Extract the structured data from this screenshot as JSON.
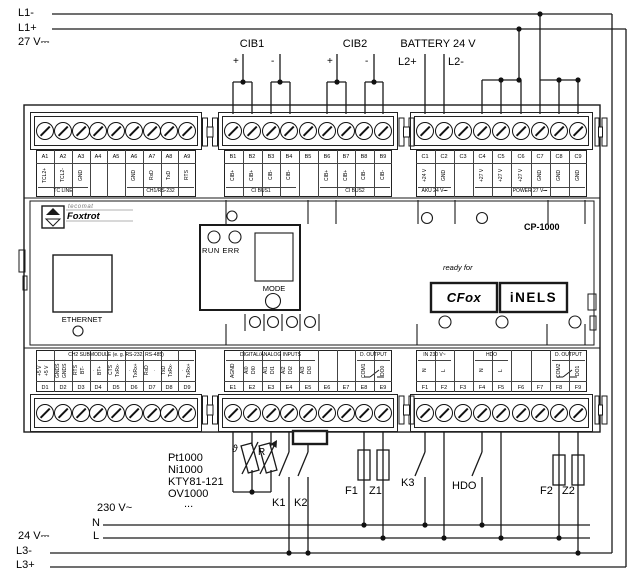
{
  "top": {
    "l1_minus": "L1-",
    "l1_plus": "L1+",
    "supply": "27 V⎓",
    "cib1": {
      "label": "CIB1",
      "plus": "+",
      "minus": "-"
    },
    "cib2": {
      "label": "CIB2",
      "plus": "+",
      "minus": "-"
    },
    "battery": {
      "label": "BATTERY 24 V",
      "l2_plus": "L2+",
      "l2_minus": "L2-"
    }
  },
  "device": {
    "model": "CP-1000",
    "brand": {
      "line1": "tecomat",
      "line2": "Foxtrot"
    },
    "ethernet": "ETHERNET",
    "panel": {
      "run_err": "RUN ERR",
      "mode": "MODE"
    },
    "ready_for": "ready for",
    "logo_cfox": "CFox",
    "logo_inels": "iNELS"
  },
  "terminal_rows": [
    {
      "id": "A",
      "numbers": [
        "A1",
        "A2",
        "A3",
        "A4",
        "A5",
        "A6",
        "A7",
        "A8",
        "A9"
      ],
      "signals": [
        "TCL2+",
        "TCL2-",
        "GND",
        "",
        "",
        "GND",
        "RxD",
        "TxD",
        "RTS"
      ],
      "groups": [
        {
          "label": "TC LINE",
          "from": 0,
          "to": 2
        },
        {
          "label": "CH1/RS-232",
          "from": 5,
          "to": 8
        }
      ]
    },
    {
      "id": "B",
      "numbers": [
        "B1",
        "B2",
        "B3",
        "B4",
        "B5",
        "B6",
        "B7",
        "B8",
        "B9"
      ],
      "signals": [
        "CIB+",
        "CIB+",
        "CIB-",
        "CIB-",
        "",
        "CIB+",
        "CIB+",
        "CIB-",
        "CIB-"
      ],
      "groups": [
        {
          "label": "CI BUS1",
          "from": 0,
          "to": 3
        },
        {
          "label": "CI BUS2",
          "from": 5,
          "to": 8
        }
      ]
    },
    {
      "id": "C",
      "numbers": [
        "C1",
        "C2",
        "C3",
        "C4",
        "C5",
        "C6",
        "C7",
        "C8",
        "C9"
      ],
      "signals": [
        "+24 V",
        "GND",
        "",
        "+27 V",
        "+27 V",
        "+27 V",
        "GND",
        "GND",
        "GND"
      ],
      "groups": [
        {
          "label": "AKU 24 V⎓",
          "from": 0,
          "to": 1
        },
        {
          "label": "POWER 27 V⎓",
          "from": 3,
          "to": 8
        }
      ]
    },
    {
      "id": "D",
      "numbers": [
        "D1",
        "D2",
        "D3",
        "D4",
        "D5",
        "D6",
        "D7",
        "D8",
        "D9"
      ],
      "signals": [
        "+5 V|+5 V",
        "GNDS|GNDS",
        "RTS|BT-",
        ".|BT+",
        "CTS|TxRx-",
        ".|TxRx+",
        "RxD|.",
        "TxD|TxRx-",
        ".|TxRx+"
      ],
      "groups": [
        {
          "label": "CH2 SUBMODULE (e. g. RS-232, RS-485)",
          "from": 0,
          "to": 8
        }
      ]
    },
    {
      "id": "E",
      "numbers": [
        "E1",
        "E2",
        "E3",
        "E4",
        "E5",
        "E6",
        "E7",
        "E8",
        "E9"
      ],
      "signals": [
        "AGND",
        "AI0|DI0",
        "AI1|DI1",
        "AI2|DI2",
        "AI3|DI3",
        "",
        "",
        "COM1",
        "DO0"
      ],
      "groups": [
        {
          "label": "DIGITAL/ANALOG INPUTS",
          "from": 0,
          "to": 4
        },
        {
          "label": "D. OUTPUT",
          "from": 7,
          "to": 8
        }
      ]
    },
    {
      "id": "F",
      "numbers": [
        "F1",
        "F2",
        "F3",
        "F4",
        "F5",
        "F6",
        "F7",
        "F8",
        "F9"
      ],
      "signals": [
        "N",
        "L",
        "",
        "N",
        "L",
        "",
        "",
        "COM2",
        "DO1"
      ],
      "groups": [
        {
          "label": "IN 230 V~",
          "from": 0,
          "to": 1
        },
        {
          "label": "HDO",
          "from": 3,
          "to": 4
        },
        {
          "label": "D. OUTPUT",
          "from": 7,
          "to": 8
        }
      ]
    }
  ],
  "bottom": {
    "sensors": [
      "Pt1000",
      "Ni1000",
      "KTY81-121",
      "OV1000",
      "..."
    ],
    "sensor_theta": "ϑ",
    "sensor_r": "R",
    "k1": "K1",
    "k2": "K2",
    "k3": "K3",
    "hdo": "HDO",
    "f1": "F1",
    "z1": "Z1",
    "f2": "F2",
    "z2": "Z2",
    "mains_label": "230 V~",
    "n": "N",
    "l": "L",
    "dc_label": "24 V⎓",
    "l3_minus": "L3-",
    "l3_plus": "L3+"
  }
}
